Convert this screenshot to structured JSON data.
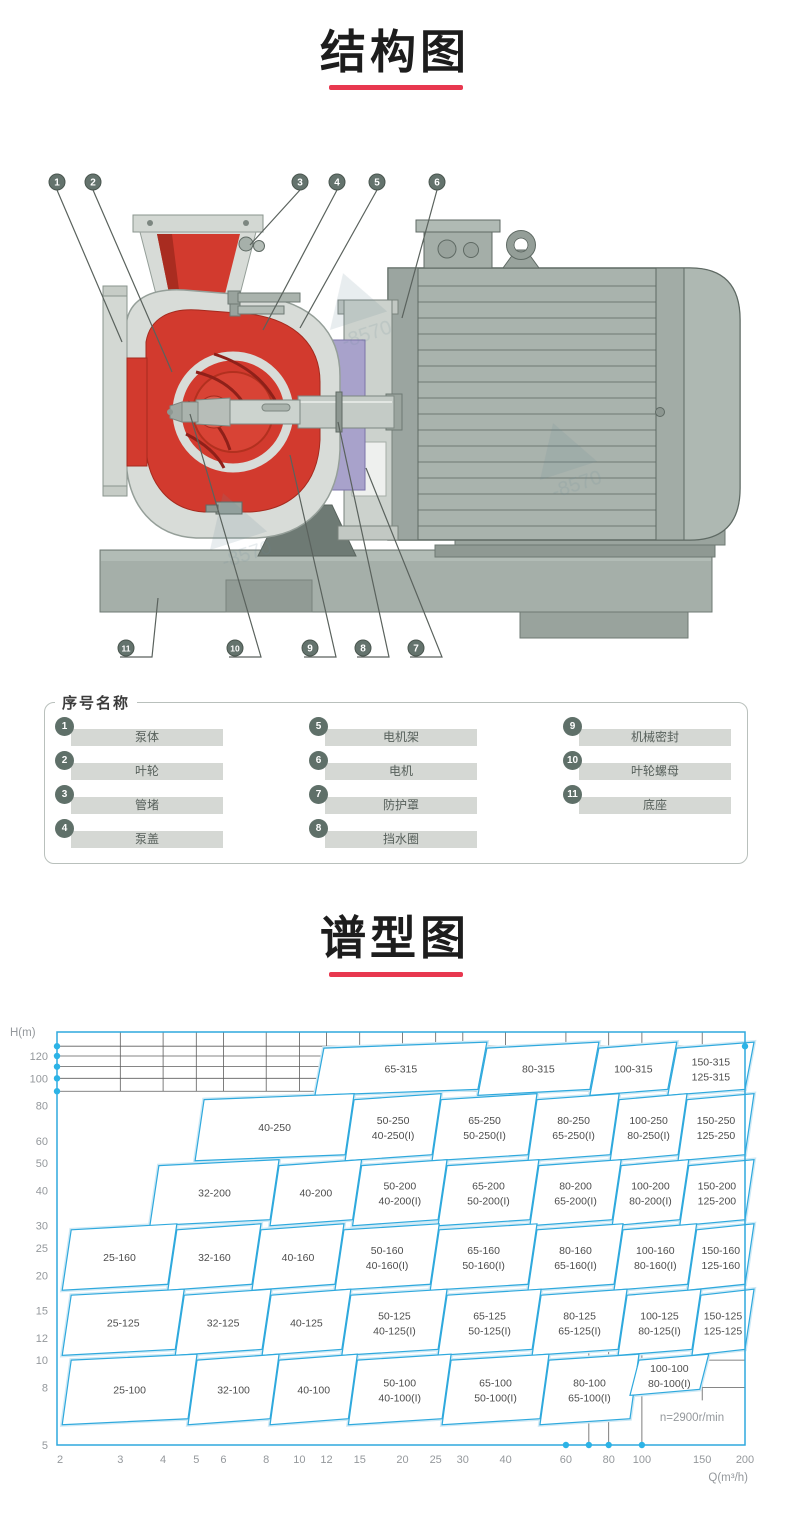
{
  "colors": {
    "accent": "#e8384f",
    "chart_line": "#2fa9dd",
    "chart_halo": "#cfe9f5",
    "chart_dot": "#2cb3e6",
    "grid": "#5e5e5e",
    "tick_text": "#94989c",
    "region_text": "#4d4d4d",
    "callout_fill": "#64736d",
    "leader": "#5a625d"
  },
  "structure_section": {
    "title": "结构图"
  },
  "spectrum_section": {
    "title": "谱型图"
  },
  "legend": {
    "title": "序号名称",
    "items": [
      {
        "num": "1",
        "label": "泵体"
      },
      {
        "num": "2",
        "label": "叶轮"
      },
      {
        "num": "3",
        "label": "管堵"
      },
      {
        "num": "4",
        "label": "泵盖"
      },
      {
        "num": "5",
        "label": "电机架"
      },
      {
        "num": "6",
        "label": "电机"
      },
      {
        "num": "7",
        "label": "防护罩"
      },
      {
        "num": "8",
        "label": "挡水圈"
      },
      {
        "num": "9",
        "label": "机械密封"
      },
      {
        "num": "10",
        "label": "叶轮螺母"
      },
      {
        "num": "11",
        "label": "底座"
      }
    ]
  },
  "diagram": {
    "watermark_fragment": "-8570",
    "top_callouts": [
      {
        "num": "1",
        "x": 57,
        "tx": 122,
        "ty": 192
      },
      {
        "num": "2",
        "x": 93,
        "tx": 172,
        "ty": 222
      },
      {
        "num": "3",
        "x": 300,
        "tx": 250,
        "ty": 95
      },
      {
        "num": "4",
        "x": 337,
        "tx": 263,
        "ty": 180
      },
      {
        "num": "5",
        "x": 377,
        "tx": 300,
        "ty": 178
      },
      {
        "num": "6",
        "x": 437,
        "tx": 402,
        "ty": 168
      }
    ],
    "bottom_callouts": [
      {
        "num": "11",
        "x": 126,
        "tx": 158,
        "ty": 448
      },
      {
        "num": "10",
        "x": 235,
        "tx": 190,
        "ty": 264
      },
      {
        "num": "9",
        "x": 310,
        "tx": 290,
        "ty": 305
      },
      {
        "num": "8",
        "x": 363,
        "tx": 338,
        "ty": 272
      },
      {
        "num": "7",
        "x": 416,
        "tx": 366,
        "ty": 318
      }
    ]
  },
  "chart_data": {
    "type": "region-map",
    "title": "谱型图",
    "x_axis": {
      "label": "Q(m³/h)",
      "scale": "log",
      "range": [
        2,
        200
      ],
      "ticks": [
        2,
        3,
        4,
        5,
        6,
        8,
        10,
        12,
        15,
        20,
        25,
        30,
        40,
        60,
        80,
        100,
        150,
        200
      ]
    },
    "y_axis": {
      "label": "H(m)",
      "scale": "log",
      "range": [
        5,
        146
      ],
      "ticks": [
        5,
        8,
        10,
        12,
        15,
        20,
        25,
        30,
        40,
        50,
        60,
        80,
        100,
        120
      ]
    },
    "annotation": "n=2900r/min",
    "top_grid_h": [
      90,
      100,
      110,
      120,
      130
    ],
    "axis_dots": {
      "left_h": [
        90,
        100,
        110,
        120,
        130
      ],
      "bottom_q": [
        60,
        70,
        80,
        100
      ],
      "corner": [
        200,
        130
      ]
    },
    "lower_right_grid": {
      "v_q": [
        70,
        80,
        100
      ],
      "v_q_short": [
        150
      ],
      "h_h": [
        12,
        10,
        8
      ],
      "from_q": 60
    },
    "regions": [
      {
        "labels": [
          "65-315"
        ],
        "q": [
          11.1,
          33.2
        ],
        "h": [
          87,
          128
        ]
      },
      {
        "labels": [
          "80-315"
        ],
        "q": [
          33.2,
          70.5
        ],
        "h": [
          87,
          128
        ]
      },
      {
        "labels": [
          "100-315"
        ],
        "q": [
          70.5,
          119
        ],
        "h": [
          87,
          128
        ]
      },
      {
        "labels": [
          "150-315",
          "125-315"
        ],
        "q": [
          119,
          200
        ],
        "h": [
          87,
          128
        ]
      },
      {
        "labels": [
          "40-250"
        ],
        "q": [
          4.96,
          13.6
        ],
        "h": [
          51,
          84
        ]
      },
      {
        "labels": [
          "50-250",
          "40-250(I)"
        ],
        "q": [
          13.6,
          24.4
        ],
        "h": [
          51,
          84
        ]
      },
      {
        "labels": [
          "65-250",
          "50-250(I)"
        ],
        "q": [
          24.4,
          46.5
        ],
        "h": [
          51,
          84
        ]
      },
      {
        "labels": [
          "80-250",
          "65-250(I)"
        ],
        "q": [
          46.5,
          80.8
        ],
        "h": [
          51,
          84
        ]
      },
      {
        "labels": [
          "100-250",
          "80-250(I)"
        ],
        "q": [
          80.8,
          127.5
        ],
        "h": [
          51,
          84
        ]
      },
      {
        "labels": [
          "150-250",
          "125-250"
        ],
        "q": [
          127.5,
          200
        ],
        "h": [
          51,
          84
        ]
      },
      {
        "labels": [
          "32-200"
        ],
        "q": [
          3.66,
          8.21
        ],
        "h": [
          30,
          49
        ]
      },
      {
        "labels": [
          "40-200"
        ],
        "q": [
          8.21,
          14.3
        ],
        "h": [
          30,
          49
        ]
      },
      {
        "labels": [
          "50-200",
          "40-200(I)"
        ],
        "q": [
          14.3,
          25.4
        ],
        "h": [
          30,
          49
        ]
      },
      {
        "labels": [
          "65-200",
          "50-200(I)"
        ],
        "q": [
          25.4,
          47.1
        ],
        "h": [
          30,
          49
        ]
      },
      {
        "labels": [
          "80-200",
          "65-200(I)"
        ],
        "q": [
          47.1,
          81.9
        ],
        "h": [
          30,
          49
        ]
      },
      {
        "labels": [
          "100-200",
          "80-200(I)"
        ],
        "q": [
          81.9,
          129
        ],
        "h": [
          30,
          49
        ]
      },
      {
        "labels": [
          "150-200",
          "125-200"
        ],
        "q": [
          129,
          200
        ],
        "h": [
          30,
          49
        ]
      },
      {
        "labels": [
          "25-160"
        ],
        "q": [
          2.03,
          4.13
        ],
        "h": [
          17.7,
          29
        ]
      },
      {
        "labels": [
          "32-160"
        ],
        "q": [
          4.13,
          7.27
        ],
        "h": [
          17.7,
          29
        ]
      },
      {
        "labels": [
          "40-160"
        ],
        "q": [
          7.27,
          12.7
        ],
        "h": [
          17.7,
          29
        ]
      },
      {
        "labels": [
          "50-160",
          "40-160(I)"
        ],
        "q": [
          12.7,
          24.1
        ],
        "h": [
          17.7,
          29
        ]
      },
      {
        "labels": [
          "65-160",
          "50-160(I)"
        ],
        "q": [
          24.1,
          46.5
        ],
        "h": [
          17.7,
          29
        ]
      },
      {
        "labels": [
          "80-160",
          "65-160(I)"
        ],
        "q": [
          46.5,
          82.9
        ],
        "h": [
          17.7,
          29
        ]
      },
      {
        "labels": [
          "100-160",
          "80-160(I)"
        ],
        "q": [
          82.9,
          136
        ],
        "h": [
          17.7,
          29
        ]
      },
      {
        "labels": [
          "150-160",
          "125-160"
        ],
        "q": [
          136,
          200
        ],
        "h": [
          17.7,
          29
        ]
      },
      {
        "labels": [
          "25-125"
        ],
        "q": [
          2.03,
          4.34
        ],
        "h": [
          10.4,
          17
        ]
      },
      {
        "labels": [
          "32-125"
        ],
        "q": [
          4.34,
          7.78
        ],
        "h": [
          10.4,
          17
        ]
      },
      {
        "labels": [
          "40-125"
        ],
        "q": [
          7.78,
          13.3
        ],
        "h": [
          10.4,
          17
        ]
      },
      {
        "labels": [
          "50-125",
          "40-125(I)"
        ],
        "q": [
          13.3,
          25.4
        ],
        "h": [
          10.4,
          17
        ]
      },
      {
        "labels": [
          "65-125",
          "50-125(I)"
        ],
        "q": [
          25.4,
          47.8
        ],
        "h": [
          10.4,
          17
        ]
      },
      {
        "labels": [
          "80-125",
          "65-125(I)"
        ],
        "q": [
          47.8,
          85.2
        ],
        "h": [
          10.4,
          17
        ]
      },
      {
        "labels": [
          "100-125",
          "80-125(I)"
        ],
        "q": [
          85.2,
          140
        ],
        "h": [
          10.4,
          17
        ]
      },
      {
        "labels": [
          "150-125",
          "125-125"
        ],
        "q": [
          140,
          200
        ],
        "h": [
          10.4,
          17
        ]
      },
      {
        "labels": [
          "25-100"
        ],
        "q": [
          2.03,
          4.73
        ],
        "h": [
          5.9,
          10
        ]
      },
      {
        "labels": [
          "32-100"
        ],
        "q": [
          4.73,
          8.21
        ],
        "h": [
          5.9,
          10
        ]
      },
      {
        "labels": [
          "40-100"
        ],
        "q": [
          8.21,
          13.9
        ],
        "h": [
          5.9,
          10
        ]
      },
      {
        "labels": [
          "50-100",
          "40-100(I)"
        ],
        "q": [
          13.9,
          26.1
        ],
        "h": [
          5.9,
          10
        ]
      },
      {
        "labels": [
          "65-100",
          "50-100(I)"
        ],
        "q": [
          26.1,
          50.4
        ],
        "h": [
          5.9,
          10
        ]
      },
      {
        "labels": [
          "80-100",
          "65-100(I)"
        ],
        "q": [
          50.4,
          92.3
        ],
        "h": [
          5.9,
          10
        ]
      },
      {
        "labels": [
          "100-100",
          "80-100(I)"
        ],
        "q": [
          92.3,
          147.5
        ],
        "h": [
          7.5,
          10
        ]
      }
    ]
  }
}
